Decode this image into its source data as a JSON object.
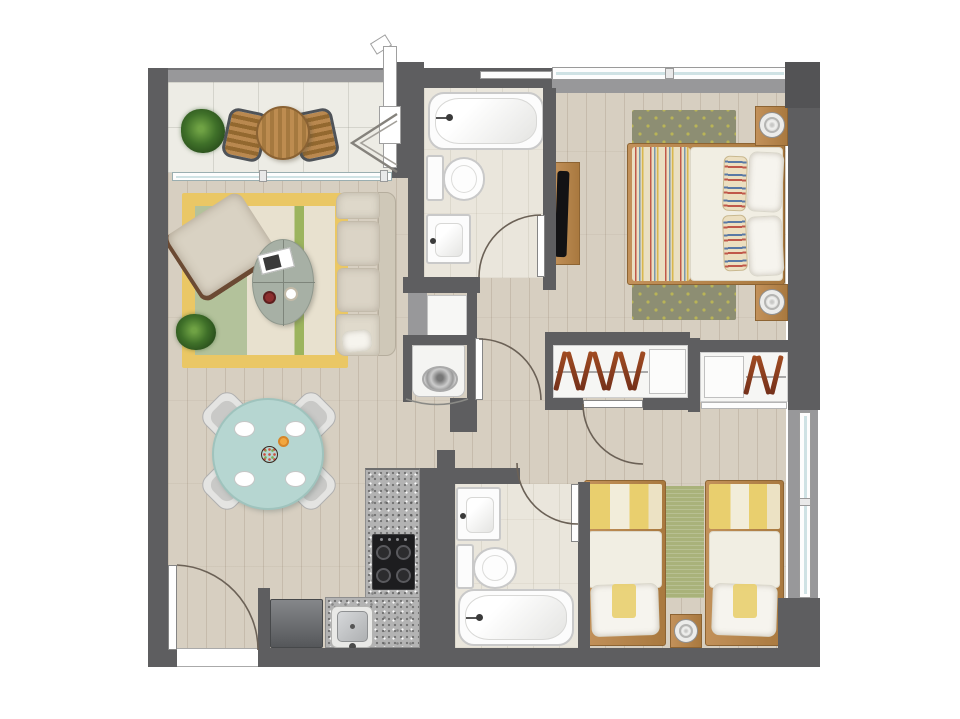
{
  "plan": {
    "type": "apartment-floor-plan",
    "view": "top-down rendered furniture plan",
    "canvas": {
      "width": 960,
      "height": 719
    }
  },
  "palette": {
    "wall": "#5e5e60",
    "wallD": "#535355",
    "wallL": "#98989a",
    "floor": "#d7cfc1",
    "tile": "#eae6dc",
    "balcony": "#edece5",
    "yellow": "#eac765",
    "sage": "#b3c29b",
    "cream": "#e8e1cf",
    "olive": "#9cb45e",
    "teal": "#b6d6d1",
    "tealD": "#9fc3bd",
    "rugm": "#8d8e73",
    "rugdot": "#b9b457",
    "rugb2": "#a9b27a",
    "blanket": "#e9cf6e",
    "duvet": "#f1eee3",
    "woodc": "#b8874b",
    "woodd": "#96693a",
    "granite": "#b3b3b3",
    "stove": "#1d1d1f",
    "hanger1": "#a14c22",
    "hanger2": "#74301a",
    "winblue": "#cfe2e4",
    "fixture": "#c9c9c9",
    "arc": "#6b6156"
  },
  "labels": {
    "floor_plan": "apartment floor plan",
    "balcony": "balcony",
    "living_room": "living room",
    "dining_area": "dining area",
    "kitchen": "kitchen",
    "hallway": "hallway",
    "laundry_niche": "laundry niche",
    "bathroom_1": "main bathroom",
    "bathroom_2": "second bathroom",
    "master_bedroom": "master bedroom",
    "bedroom_2": "second bedroom",
    "potted_plant": "potted plant",
    "bistro_table": "bistro table",
    "outdoor_chair": "outdoor chair",
    "sliding_door": "sliding glass door",
    "folding_door": "folding door",
    "vent_pipe": "vent pipe",
    "area_rug": "area rug",
    "armchair": "armchair",
    "coffee_table": "coffee table",
    "magazine": "magazine",
    "bowl": "bowl",
    "cup": "cup",
    "sofa": "sofa",
    "dining_table": "dining table",
    "dining_chair": "dining chair",
    "place_setting": "place setting",
    "salad_bowl": "salad bowl",
    "juice_glass": "juice glass",
    "refrigerator": "refrigerator",
    "kitchen_counter": "granite kitchen counter",
    "cooktop": "4-burner cooktop",
    "kitchen_sink": "kitchen sink",
    "bathtub": "bathtub",
    "toilet": "toilet",
    "washbasin": "washbasin",
    "washing_machine": "washing machine",
    "storage_shelf": "storage shelf",
    "vent_shaft": "vent shaft",
    "wardrobe": "wardrobe",
    "clothes_rail": "clothes rail",
    "clothes_hanger": "clothes hanger",
    "wardrobe_shelf": "wardrobe shelf",
    "wardrobe_door": "wardrobe sliding door",
    "double_bed": "double bed",
    "nightstand": "nightstand",
    "table_lamp": "table lamp",
    "tv_console": "TV console",
    "television": "television",
    "bedroom_rug": "bedroom rug",
    "single_bed": "single bed",
    "bedside_table": "bedside table",
    "pillow": "pillow",
    "blanket": "blanket",
    "duvet": "duvet",
    "window": "window",
    "door": "interior door",
    "entrance_door": "entrance door",
    "door_swing": "door swing arc",
    "threshold": "entrance threshold"
  },
  "rooms": [
    {
      "id": "balcony",
      "label": "balcony",
      "furniture": [
        "potted plant",
        "round bistro table",
        "2 outdoor chairs",
        "folding door",
        "vent pipe"
      ]
    },
    {
      "id": "living-room",
      "label": "living room",
      "furniture": [
        "yellow-bordered area rug",
        "armchair",
        "3-seat sofa",
        "oval coffee table",
        "magazine",
        "bowl",
        "cup",
        "potted plant"
      ]
    },
    {
      "id": "dining-area",
      "label": "dining area",
      "furniture": [
        "round teal dining table",
        "4 dining chairs",
        "4 place settings",
        "salad bowl",
        "juice glass"
      ]
    },
    {
      "id": "kitchen",
      "label": "kitchen",
      "furniture": [
        "L-shaped granite counter",
        "4-burner cooktop",
        "sink",
        "refrigerator"
      ]
    },
    {
      "id": "laundry-niche",
      "label": "laundry niche",
      "furniture": [
        "storage shelf",
        "washing machine"
      ]
    },
    {
      "id": "main-bathroom",
      "label": "main bathroom",
      "furniture": [
        "bathtub",
        "toilet",
        "washbasin"
      ]
    },
    {
      "id": "second-bathroom",
      "label": "second bathroom",
      "furniture": [
        "washbasin",
        "toilet",
        "bathtub"
      ]
    },
    {
      "id": "master-bedroom",
      "label": "master bedroom",
      "furniture": [
        "double bed",
        "striped throw blanket",
        "2 striped bolster pillows",
        "2 pillows",
        "2 nightstands with lamps",
        "patterned rug",
        "TV console with television",
        "wardrobe with hangers and shelf"
      ]
    },
    {
      "id": "second-bedroom",
      "label": "second bedroom",
      "furniture": [
        "2 single beds with yellow blankets",
        "green rug",
        "bedside table with lamp",
        "wardrobe with shelf and hangers"
      ]
    },
    {
      "id": "hallway",
      "label": "hallway",
      "furniture": []
    }
  ],
  "wardrobes": {
    "left": {
      "hanger_count": 7,
      "has_shelf": true
    },
    "right": {
      "hanger_count": 3,
      "has_shelf": true
    }
  },
  "openings": {
    "windows": [
      "master bedroom north window",
      "second bedroom east window",
      "main bathroom vent window"
    ],
    "doors": [
      "entrance door (bottom left)",
      "balcony folding door",
      "balcony sliding door",
      "main bathroom door",
      "hallway door",
      "master bedroom door",
      "second bathroom door",
      "laundry niche folding door"
    ]
  }
}
